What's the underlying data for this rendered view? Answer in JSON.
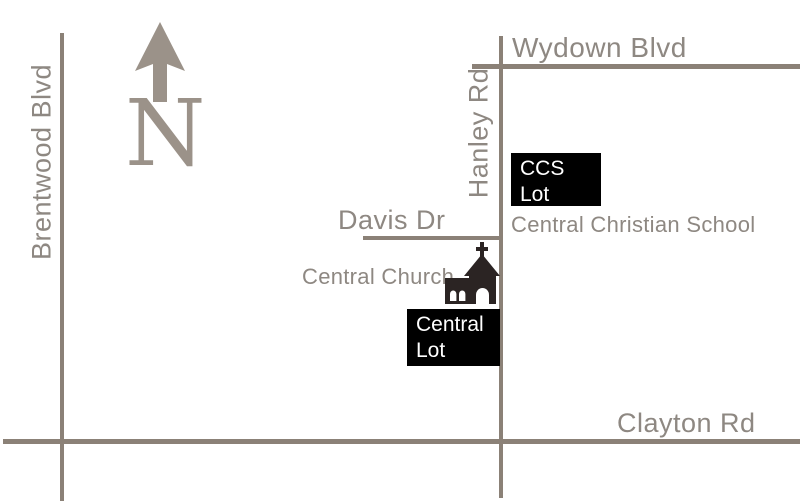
{
  "map": {
    "streets": {
      "brentwood": "Brentwood Blvd",
      "wydown": "Wydown Blvd",
      "hanley": "Hanley Rd",
      "davis": "Davis Dr",
      "clayton": "Clayton Rd"
    },
    "places": {
      "school": "Central Christian School",
      "church": "Central Church"
    },
    "lots": {
      "ccs": {
        "line1": "CCS",
        "line2": "Lot"
      },
      "central": {
        "line1": "Central",
        "line2": "Lot"
      }
    },
    "compass": {
      "letter": "N"
    }
  },
  "colors": {
    "road": "#8b8177",
    "street_label": "#8e8882",
    "compass": "#9b9289",
    "lot_background": "#000000",
    "lot_text": "#ffffff",
    "church_silhouette": "#2b2423"
  }
}
